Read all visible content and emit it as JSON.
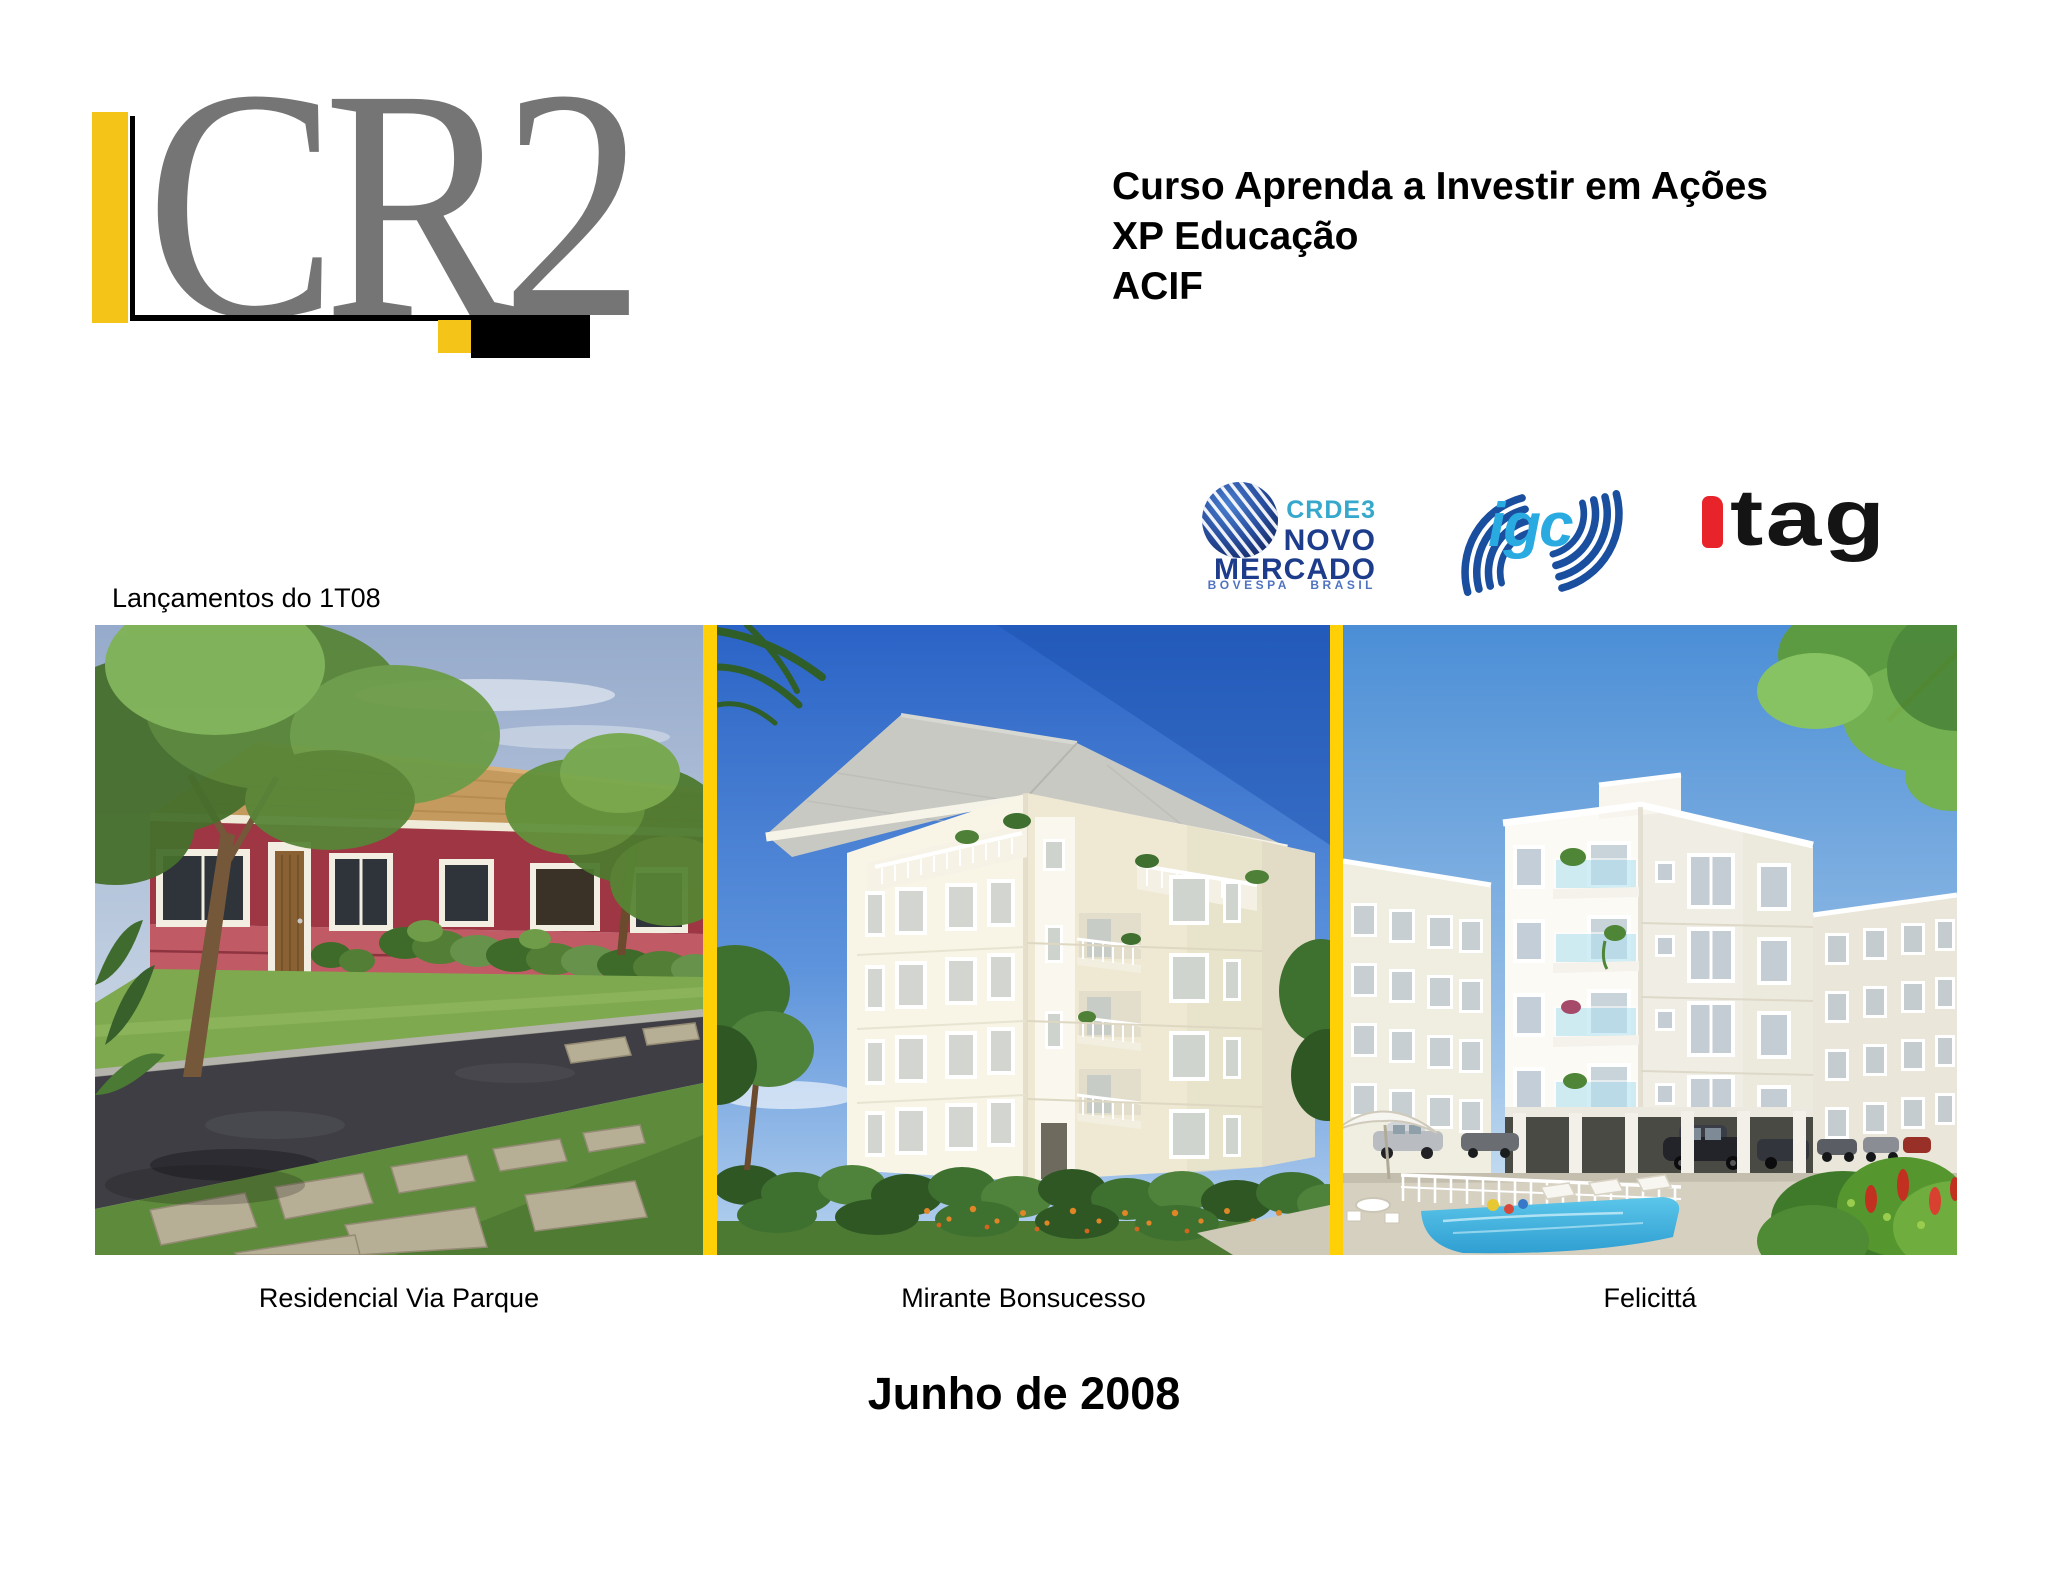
{
  "brand": {
    "name": "CR2",
    "letter_color": "#757575",
    "accent_yellow": "#F5C419",
    "accent_black": "#000000"
  },
  "header": {
    "lines": [
      "Curso Aprenda a Investir em Ações",
      "XP Educação",
      "ACIF"
    ]
  },
  "seals": {
    "novo_mercado": {
      "ticker": "CRDE3",
      "word1": "NOVO",
      "word2": "MERCADO",
      "tagline": "BOVESPA BRASIL",
      "ticker_color": "#35A8CC",
      "navy": "#1D3D8C",
      "tagline_color": "#5073C0"
    },
    "igc": {
      "label": "igc",
      "label_color": "#29ABE2",
      "swoosh_color": "#1A4E9E"
    },
    "itag": {
      "label": "tag",
      "mark_color": "#E8232A",
      "label_color": "#141414"
    }
  },
  "section": {
    "label": "Lançamentos do 1T08"
  },
  "gallery": {
    "separator_color": "#FFD005",
    "items": [
      {
        "caption": "Residencial Via Parque"
      },
      {
        "caption": "Mirante Bonsucesso"
      },
      {
        "caption": "Felicittá"
      }
    ]
  },
  "footer": {
    "date_title": "Junho de 2008"
  }
}
